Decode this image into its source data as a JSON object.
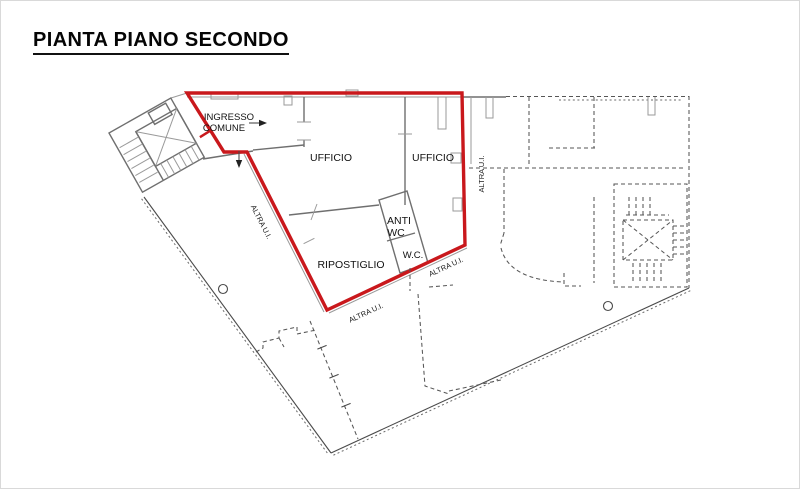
{
  "title": "PIANTA PIANO SECONDO",
  "plan": {
    "unit_rooms": {
      "ingresso_line1": "INGRESSO",
      "ingresso_line2": "COMUNE",
      "ufficio_left": "UFFICIO",
      "ufficio_right": "UFFICIO",
      "anti_wc_line1": "ANTI",
      "anti_wc_line2": "WC",
      "wc": "W.C.",
      "ripostiglio": "RIPOSTIGLIO"
    },
    "other_units": {
      "altra_left": "ALTRA U.I.",
      "altra_right": "ALTRA U.I.",
      "altra_bottom_1": "ALTRA U.I.",
      "altra_bottom_2": "ALTRA U.I."
    },
    "colors": {
      "highlight_red": "#c9181c",
      "wall_gray": "#6f6f6f",
      "dashed_gray": "#565656"
    }
  }
}
